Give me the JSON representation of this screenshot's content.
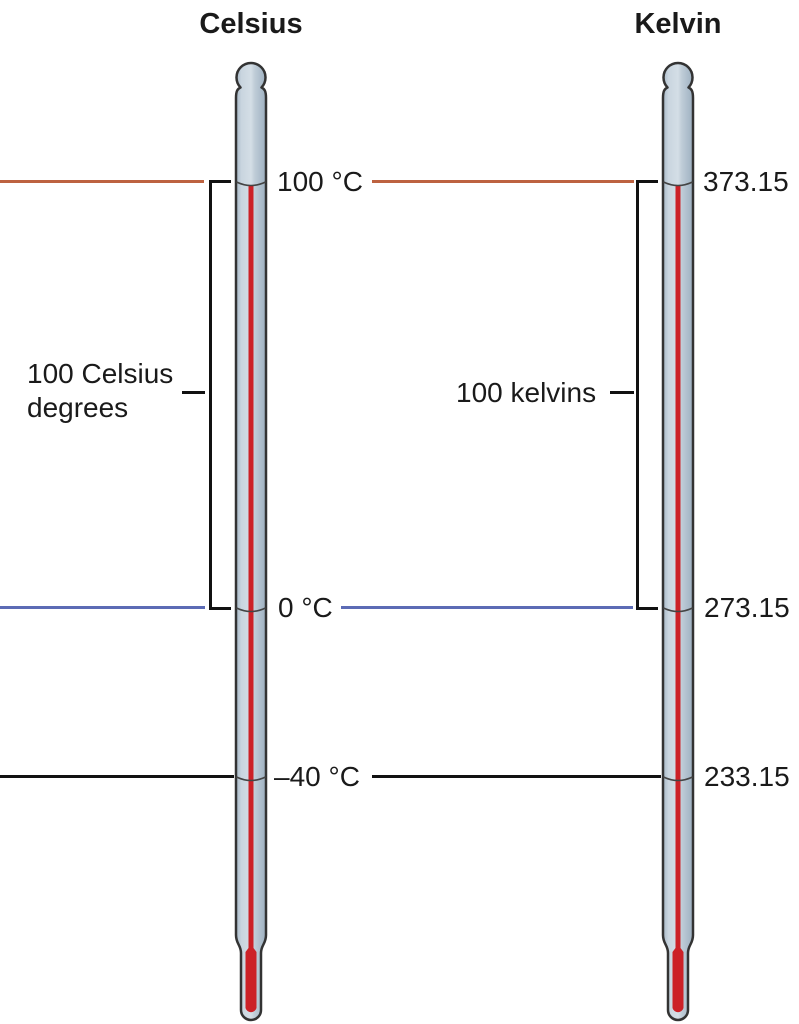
{
  "titles": {
    "celsius": "Celsius",
    "kelvin": "Kelvin"
  },
  "temperature_levels": [
    {
      "id": "boiling-point",
      "celsius_label": "100 °C",
      "kelvin_label": "373.15",
      "line_color": "#bd6240"
    },
    {
      "id": "freezing-point",
      "celsius_label": "0 °C",
      "kelvin_label": "273.15",
      "line_color": "#5c6bb5"
    },
    {
      "id": "minus-forty",
      "celsius_label": "–40 °C",
      "kelvin_label": "233.15",
      "line_color": "#111111"
    }
  ],
  "interval_labels": {
    "celsius_line1": "100 Celsius",
    "celsius_line2": "degrees",
    "kelvin": "100 kelvins"
  },
  "colors": {
    "mercury": "#cc2127",
    "glass_highlight": "#d4dee6",
    "glass_mid": "#bac8d4",
    "glass_shadow": "#9db0c0",
    "outline": "#333333",
    "boiling_line": "#bd6240",
    "freezing_line": "#5c6bb5",
    "minus40_line": "#111111",
    "text": "#1a1a1a"
  }
}
